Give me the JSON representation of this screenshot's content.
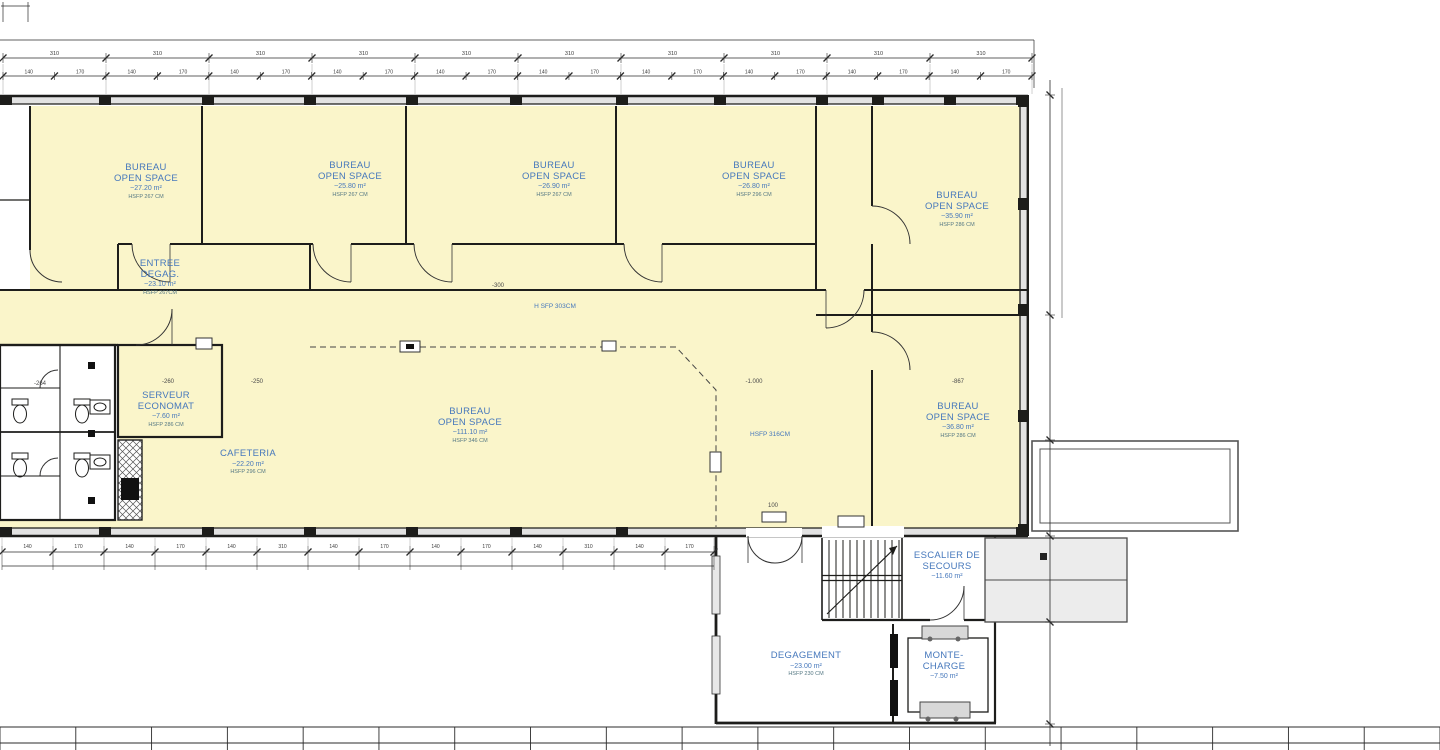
{
  "colors": {
    "room_fill": "#FAF5CA",
    "wall": "#1d1d1b",
    "label_blue": "#4678BC",
    "hsfp_teal": "#557883",
    "window_gray": "#e2e2e2",
    "annex_gray": "#ececec",
    "dim_line": "#2b2b2b"
  },
  "rooms": [
    {
      "id": "bureau-open-space-1",
      "x": 146,
      "y": 163,
      "lines": [
        "BUREAU",
        "OPEN SPACE"
      ],
      "area": "~27.20 m²",
      "hsfp": "HSFP 267 CM"
    },
    {
      "id": "bureau-open-space-2",
      "x": 350,
      "y": 161,
      "lines": [
        "BUREAU",
        "OPEN SPACE"
      ],
      "area": "~25.80 m²",
      "hsfp": "HSFP 267 CM"
    },
    {
      "id": "bureau-open-space-3",
      "x": 554,
      "y": 161,
      "lines": [
        "BUREAU",
        "OPEN SPACE"
      ],
      "area": "~26.90 m²",
      "hsfp": "HSFP 267 CM"
    },
    {
      "id": "bureau-open-space-4",
      "x": 754,
      "y": 161,
      "lines": [
        "BUREAU",
        "OPEN SPACE"
      ],
      "area": "~26.80 m²",
      "hsfp": "HSFP 296 CM"
    },
    {
      "id": "bureau-open-space-5",
      "x": 957,
      "y": 191,
      "lines": [
        "BUREAU",
        "OPEN SPACE"
      ],
      "area": "~35.90 m²",
      "hsfp": "HSFP 286 CM"
    },
    {
      "id": "entree-degagement",
      "x": 160,
      "y": 259,
      "lines": [
        "ENTREE",
        "DEGAG."
      ],
      "area": "~23.10 m²",
      "hsfp": "HSFP 267CM"
    },
    {
      "id": "serveur-economat",
      "x": 166,
      "y": 391,
      "lines": [
        "SERVEUR",
        "ECONOMAT"
      ],
      "area": "~7.60 m²",
      "hsfp": "HSFP 286 CM"
    },
    {
      "id": "cafeteria",
      "x": 248,
      "y": 449,
      "lines": [
        "CAFETERIA"
      ],
      "area": "~22.20 m²",
      "hsfp": "HSFP 296 CM"
    },
    {
      "id": "bureau-open-space-6",
      "x": 470,
      "y": 407,
      "lines": [
        "BUREAU",
        "OPEN SPACE"
      ],
      "area": "~111.10 m²",
      "hsfp": "HSFP 346 CM"
    },
    {
      "id": "bureau-open-space-7",
      "x": 958,
      "y": 402,
      "lines": [
        "BUREAU",
        "OPEN SPACE"
      ],
      "area": "~36.80 m²",
      "hsfp": "HSFP 286 CM"
    },
    {
      "id": "escalier-de-secours",
      "x": 947,
      "y": 551,
      "lines": [
        "ESCALIER DE",
        "SECOURS"
      ],
      "area": "~11.60 m²",
      "hsfp": null
    },
    {
      "id": "degagement",
      "x": 806,
      "y": 651,
      "lines": [
        "DEGAGEMENT"
      ],
      "area": "~23.00 m²",
      "hsfp": "HSFP 230 CM"
    },
    {
      "id": "monte-charge",
      "x": 944,
      "y": 651,
      "lines": [
        "MONTE-",
        "CHARGE"
      ],
      "area": "~7.50 m²",
      "hsfp": null
    }
  ],
  "annotations": [
    {
      "text": "H SFP 303CM",
      "x": 555,
      "y": 303,
      "style": "blue"
    },
    {
      "text": "HSFP 316CM",
      "x": 770,
      "y": 431,
      "style": "blue"
    },
    {
      "text": "-264",
      "x": 40,
      "y": 381,
      "style": "dim"
    },
    {
      "text": "-260",
      "x": 168,
      "y": 379,
      "style": "dim"
    },
    {
      "text": "-250",
      "x": 257,
      "y": 379,
      "style": "dim"
    },
    {
      "text": "-300",
      "x": 498,
      "y": 283,
      "style": "dim"
    },
    {
      "text": "-1.000",
      "x": 754,
      "y": 379,
      "style": "dim"
    },
    {
      "text": "-867",
      "x": 958,
      "y": 379,
      "style": "dim"
    },
    {
      "text": "100",
      "x": 773,
      "y": 503,
      "style": "dim"
    }
  ],
  "dimensions": {
    "top_major": {
      "y": 58,
      "ticks": [
        3,
        106,
        209,
        312,
        415,
        518,
        621,
        724,
        827,
        930,
        1032
      ],
      "labels": [
        "310",
        "310",
        "310",
        "310",
        "310",
        "310",
        "310",
        "310",
        "310",
        "310"
      ]
    },
    "top_minor": {
      "y": 76,
      "x_start": 3,
      "x_end": 1032,
      "segments": 20,
      "labels": [
        "140",
        "170",
        "140",
        "170",
        "140",
        "170",
        "140",
        "170",
        "140",
        "170",
        "140",
        "170",
        "140",
        "170",
        "140",
        "170",
        "140",
        "170",
        "140",
        "170"
      ]
    },
    "bottom_inner": {
      "y_line1": 552,
      "y_line2": 566,
      "ticks": [
        2,
        53,
        104,
        155,
        206,
        257,
        308,
        359,
        410,
        461,
        512,
        563,
        614,
        665,
        714
      ],
      "labels": [
        "140",
        "170",
        "140",
        "170",
        "140",
        "310",
        "140",
        "170",
        "140",
        "170",
        "140",
        "310",
        "140",
        "170"
      ]
    },
    "right_vertical": {
      "x": 1050,
      "y_start": 80,
      "y_end": 746,
      "ticks": [
        95,
        315,
        440,
        536,
        622,
        724
      ]
    },
    "page_bottom": {
      "y_line1": 727,
      "y_line2": 743,
      "x_end": 1440,
      "segments": 19
    }
  }
}
